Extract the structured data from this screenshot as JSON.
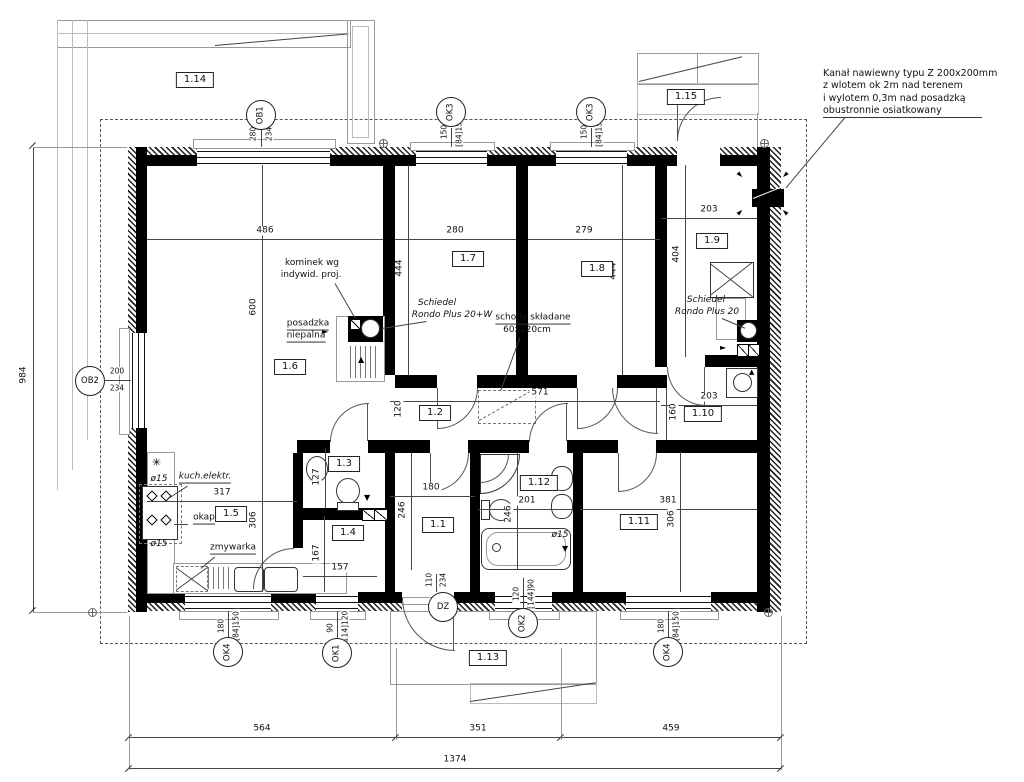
{
  "rooms": {
    "r1": "1.1",
    "r2": "1.2",
    "r3": "1.3",
    "r4": "1.4",
    "r5": "1.5",
    "r6": "1.6",
    "r7": "1.7",
    "r8": "1.8",
    "r9": "1.9",
    "r10": "1.10",
    "r11": "1.11",
    "r12": "1.12",
    "r13": "1.13",
    "r14": "1.14",
    "r15": "1.15"
  },
  "markers": {
    "ob1": {
      "label": "OB1",
      "d1": "280",
      "d2": "234"
    },
    "ok3": {
      "label": "OK3",
      "d1": "150",
      "d2": "[84]150"
    },
    "ob2": {
      "label": "OB2",
      "d1": "200",
      "d2": "234"
    },
    "ok4": {
      "label": "OK4",
      "d1": "180",
      "d2": "[84]150"
    },
    "ok1": {
      "label": "OK1",
      "d1": "90",
      "d2": "[114]120"
    },
    "dz": {
      "label": "DZ",
      "d1": "110",
      "d2": "234"
    },
    "ok2": {
      "label": "OK2",
      "d1": "120",
      "d2": "[144]90"
    }
  },
  "dims": {
    "d486": "486",
    "d280": "280",
    "d279": "279",
    "d203_19": "203",
    "d600": "600",
    "d444_l": "444",
    "d444_r": "444",
    "d404": "404",
    "d571": "571",
    "d120": "120",
    "d203_110": "203",
    "d160": "160",
    "d317": "317",
    "d306_k": "306",
    "d127": "127",
    "d180": "180",
    "d246_l": "246",
    "d201": "201",
    "d246_r": "246",
    "d381": "381",
    "d306_s": "306",
    "d167": "167",
    "d157": "157",
    "d984": "984",
    "d564": "564",
    "d351": "351",
    "d459": "459",
    "d1374": "1374"
  },
  "ann": {
    "fireplace1": "kominek wg",
    "fireplace2": "indywid. proj.",
    "floor1": "posadzka",
    "floor2": "niepalna",
    "chimney1a": "Schiedel",
    "chimney1b": "Rondo Plus 20+W",
    "stairs1": "schody składane",
    "stairs2": "60x120cm",
    "chimney2a": "Schiedel",
    "chimney2b": "Rondo Plus 20",
    "cooker": "kuch.elektr.",
    "hood": "okap",
    "dishwasher": "zmywarka",
    "pipe15": "ø15",
    "vent1": "Kanał nawiewny typu Z 200x200mm",
    "vent2": "z wlotem ok 2m nad terenem",
    "vent3": "i wylotem 0,3m nad posadzką",
    "vent4": "obustronnie osiatkowany"
  },
  "icons": {
    "freezer": "✳",
    "arrow_up": "▲",
    "arrow_down": "▼",
    "arrow_right": "►",
    "vent_arrow": "►"
  },
  "colors": {
    "wall": "#000000",
    "line": "#444444",
    "dashed_roof": "#555555"
  }
}
